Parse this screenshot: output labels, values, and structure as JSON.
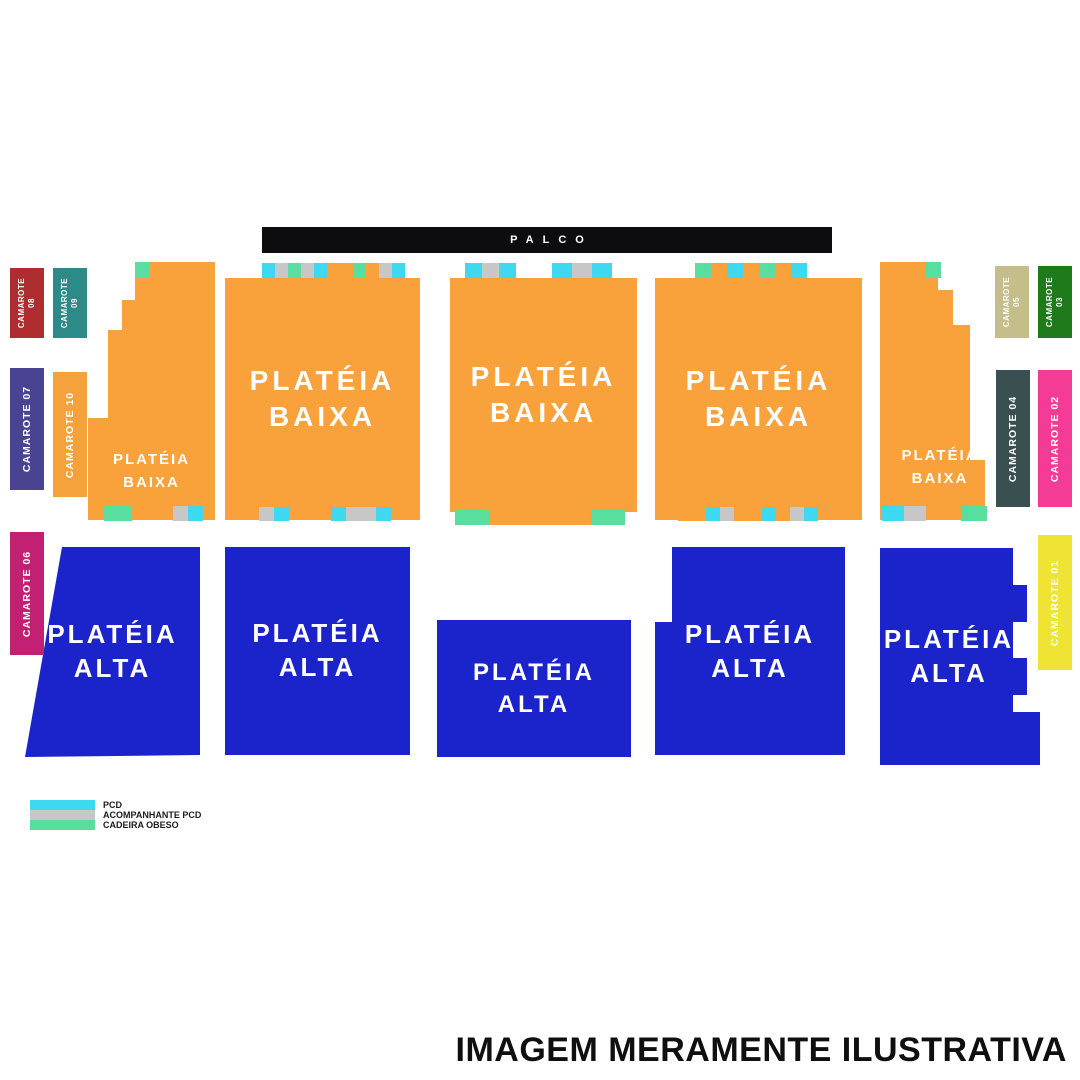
{
  "stage": {
    "label": "PALCO"
  },
  "colors": {
    "stage": "#0d0d0f",
    "orange": "#F9A13B",
    "blue": "#1B23CB"
  },
  "palette": {
    "pcd": "#3FD8F1",
    "comp": "#C7C7C7",
    "obeso": "#58DE9F",
    "fill": "#F9A13B"
  },
  "sections": {
    "baixa_label": "PLATÉIA BAIXA",
    "alta_label": "PLATÉIA ALTA"
  },
  "camarotes": {
    "c08": {
      "line1": "CAMAROTE",
      "line2": "08",
      "color": "#AF2C31"
    },
    "c09": {
      "line1": "CAMAROTE",
      "line2": "09",
      "color": "#2D8A89"
    },
    "c07": {
      "line1": "CAMAROTE 07",
      "line2": "",
      "color": "#4A4392"
    },
    "c10": {
      "line1": "CAMAROTE 10",
      "line2": "",
      "color": "#F6A23C"
    },
    "c06": {
      "line1": "CAMAROTE 06",
      "line2": "",
      "color": "#C12073"
    },
    "c05": {
      "line1": "CAMAROTE",
      "line2": "05",
      "color": "#C6BE8A"
    },
    "c03": {
      "line1": "CAMAROTE",
      "line2": "03",
      "color": "#1E7A1B"
    },
    "c04": {
      "line1": "CAMAROTE 04",
      "line2": "",
      "color": "#3A4F50"
    },
    "c02": {
      "line1": "CAMAROTE 02",
      "line2": "",
      "color": "#F43C96"
    },
    "c01": {
      "line1": "CAMAROTE 01",
      "line2": "",
      "color": "#EFE334"
    }
  },
  "seat_strips": {
    "s1t": {
      "cell_w": 14,
      "cells": [
        "obeso"
      ]
    },
    "s2t": {
      "cell_w": 13,
      "cells": [
        "pcd",
        "comp",
        "obeso",
        "comp",
        "pcd",
        "fill",
        "fill",
        "obeso",
        "fill",
        "comp",
        "pcd"
      ]
    },
    "s3tl": {
      "cell_w": 17,
      "cells": [
        "pcd",
        "comp",
        "pcd"
      ]
    },
    "s3tr": {
      "cell_w": 20,
      "cells": [
        "pcd",
        "comp",
        "pcd"
      ]
    },
    "s4t": {
      "cell_w": 16,
      "cells": [
        "obeso",
        "fill",
        "pcd",
        "fill",
        "obeso",
        "fill",
        "pcd"
      ]
    },
    "s5t": {
      "cell_w": 15,
      "cells": [
        "obeso"
      ]
    },
    "s1bl": {
      "cell_w": 14,
      "cells": [
        "obeso",
        "obeso"
      ]
    },
    "s1br": {
      "cell_w": 15,
      "cells": [
        "comp",
        "pcd"
      ]
    },
    "s2bl": {
      "cell_w": 15,
      "cells": [
        "comp",
        "pcd"
      ]
    },
    "s2br": {
      "cell_w": 15,
      "cells": [
        "pcd",
        "comp",
        "comp",
        "pcd"
      ]
    },
    "s3b": {
      "cell_w": 17,
      "cells": [
        "obeso",
        "obeso",
        "fill",
        "fill",
        "fill",
        "fill",
        "fill",
        "fill",
        "obeso",
        "obeso"
      ]
    },
    "s4b": {
      "cell_w": 14,
      "cells": [
        "fill",
        "fill",
        "pcd",
        "comp",
        "fill",
        "fill",
        "pcd",
        "fill",
        "comp",
        "pcd"
      ]
    },
    "s5bl": {
      "cell_w": 11,
      "cells": [
        "pcd",
        "pcd",
        "comp",
        "comp"
      ]
    },
    "s5br": {
      "cell_w": 13,
      "cells": [
        "obeso",
        "obeso"
      ]
    }
  },
  "legend": {
    "items": [
      {
        "label": "PCD",
        "color": "#3FD8F1"
      },
      {
        "label": "ACOMPANHANTE PCD",
        "color": "#C7C7C7"
      },
      {
        "label": "CADEIRA OBESO",
        "color": "#58DE9F"
      }
    ]
  },
  "disclaimer": "IMAGEM MERAMENTE ILUSTRATIVA"
}
